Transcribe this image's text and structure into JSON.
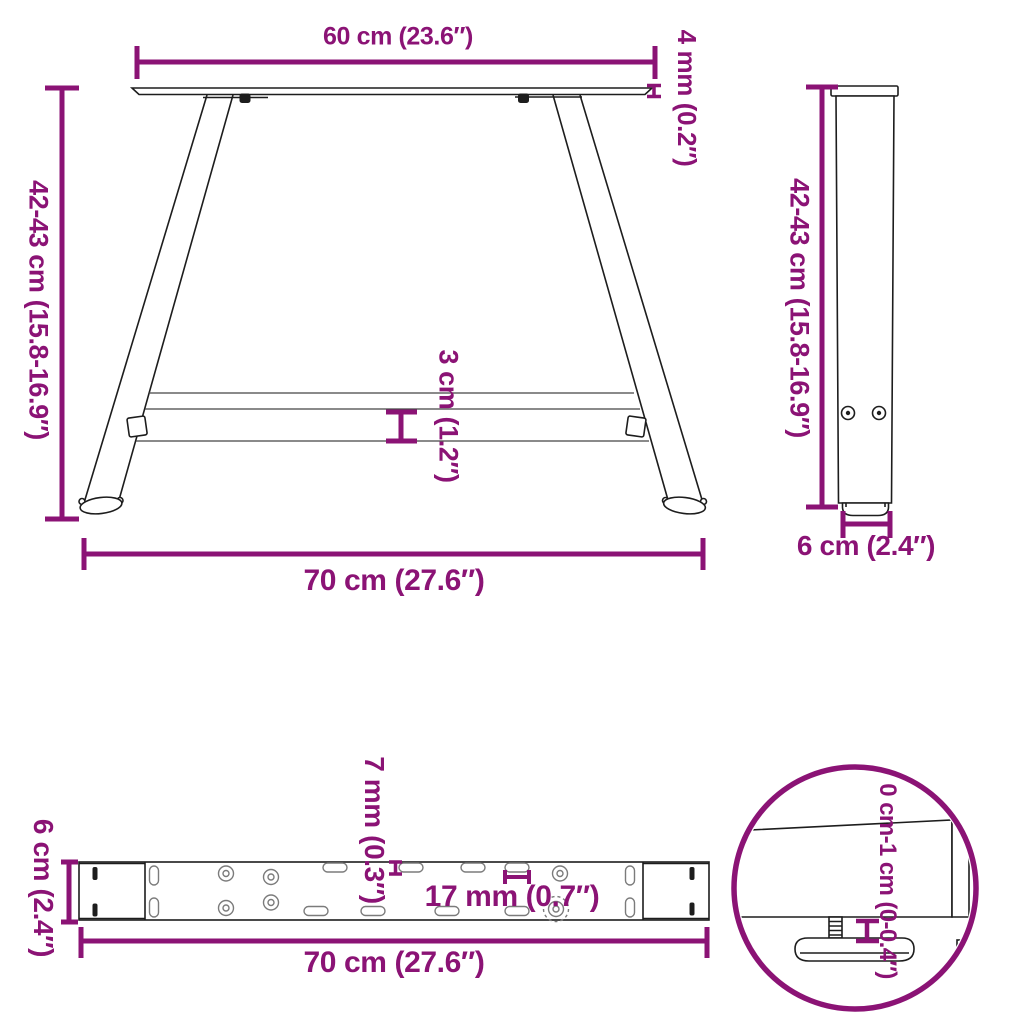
{
  "title": "A-shaped table leg dimension diagram",
  "colors": {
    "dimension": "#8B1375",
    "line": "#1d1d1d"
  },
  "views": {
    "front": {
      "top_width": "60 cm (23.6″)",
      "plate_thickness": "4 mm (0.2″)",
      "height": "42-43 cm (15.8-16.9″)",
      "crossbar_height": "3 cm (1.2″)",
      "base_width": "70 cm (27.6″)"
    },
    "side": {
      "height": "42-43 cm (15.8-16.9″)",
      "foot_depth": "6 cm (2.4″)"
    },
    "bottom": {
      "bar_depth": "6 cm (2.4″)",
      "slot_height": "7 mm (0.3″)",
      "hole_diameter": "17 mm (0.7″)",
      "bar_length": "70 cm (27.6″)"
    },
    "detail": {
      "adjustment_range": "0 cm-1 cm (0-0.4″)"
    }
  }
}
